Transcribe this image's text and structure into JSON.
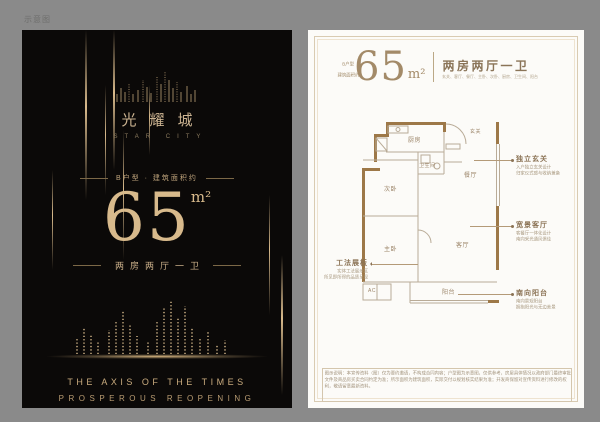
{
  "watermark": "示意图",
  "poster": {
    "brand_zh": "光耀城",
    "brand_en": "STAR CITY",
    "area_caption": "B户型 · 建筑面积约",
    "area_value": "65",
    "area_unit": "m²",
    "layout": "两房两厅一卫",
    "slogan_line1": "THE AXIS OF THE TIMES",
    "slogan_line2": "PROSPEROUS REOPENING"
  },
  "page": {
    "type_label": "B户型",
    "area_prefix": "建筑面积约",
    "area_value": "65",
    "area_unit": "m²",
    "layout_title": "两房两厅一卫",
    "rooms_line": "玄关、客厅、餐厅、主卧、次卧、厨房、卫生间、阳台",
    "floor_plan": {
      "rooms": {
        "kitchen": "厨房",
        "bath": "卫生间",
        "dining": "餐厅",
        "entry": "玄关",
        "bedroom2": "次卧",
        "master": "主卧",
        "living": "客厅",
        "balcony": "阳台",
        "ac1": "AC"
      }
    },
    "callout_left": {
      "title": "工法展板",
      "desc1": "实体工法展示区",
      "desc2": "所见即所得的品质呈现"
    },
    "callouts_right": [
      {
        "title": "独立玄关",
        "desc1": "入户独立玄关设计",
        "desc2": "归家仪式感与收纳兼备"
      },
      {
        "title": "宽景客厅",
        "desc1": "客餐厅一体化设计",
        "desc2": "南向采光通风俱佳"
      },
      {
        "title": "南向阳台",
        "desc1": "南向景观阳台",
        "desc2": "拥抱阳光与无边美景"
      }
    ],
    "disclaimer": "图示说明：本宣传资料（图）仅为要约邀请，不构成合同内容；户型图为示意图，仅供参考，房屋具体情况以政府部门最终审批文件及商品房买卖合同约定为准；所示面积为建筑面积，实际交付以规划核实结果为准；开发商保留对宣传资料进行修改的权利，敬请留意最新资料。"
  }
}
